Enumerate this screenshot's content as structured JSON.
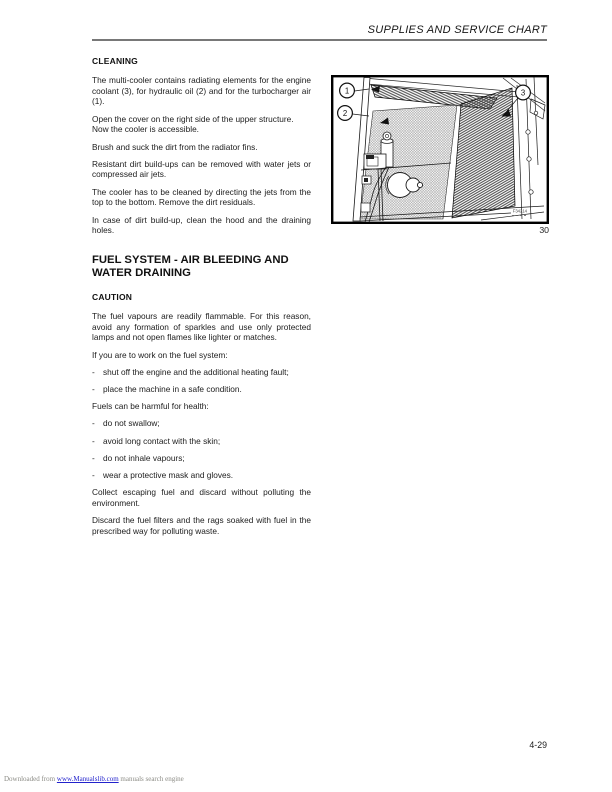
{
  "header": {
    "title": "SUPPLIES AND SERVICE CHART"
  },
  "cleaning": {
    "heading": "CLEANING",
    "p1": "The multi-cooler contains radiating elements for the engine coolant (3), for hydraulic oil (2) and for the turbocharger air (1).",
    "p2": "Open the cover on the right side of the upper structure.",
    "p2b": "Now the cooler is accessible.",
    "p3": "Brush and suck the dirt from the radiator fins.",
    "p4": "Resistant dirt build-ups can be removed with water jets or compressed air jets.",
    "p5": "The cooler has to be cleaned by directing the jets from the top to the bottom. Remove the dirt residuals.",
    "p6": "In case of dirt build-up, clean the hood and the draining holes."
  },
  "fuel": {
    "heading": "FUEL SYSTEM - AIR BLEEDING AND WATER DRAINING",
    "caution_heading": "CAUTION",
    "p1": "The fuel vapours are readily flammable. For this reason, avoid any formation of sparkles and use only protected lamps and not open flames like lighter or matches.",
    "p2": "If you are to work on the fuel system:",
    "bullet_char": "-",
    "b1": "shut off the engine and the additional heating fault;",
    "b2": "place the machine in a safe condition.",
    "p3": "Fuels can be harmful for health:",
    "b3": "do not swallow;",
    "b4": "avoid long contact with the skin;",
    "b5": "do not inhale vapours;",
    "b6": "wear a protective mask and gloves.",
    "p4": "Collect escaping fuel and discard without polluting the environment.",
    "p5": "Discard the fuel filters and the rags soaked with fuel in the prescribed way for polluting waste."
  },
  "figure": {
    "callout_1": "1",
    "callout_2": "2",
    "callout_3": "3",
    "image_code": "F34214",
    "caption": "30"
  },
  "footer": {
    "page_number": "4-29",
    "watermark_prefix": "Downloaded from",
    "watermark_link": "www.Manualslib.com",
    "watermark_suffix": "manuals search engine"
  }
}
